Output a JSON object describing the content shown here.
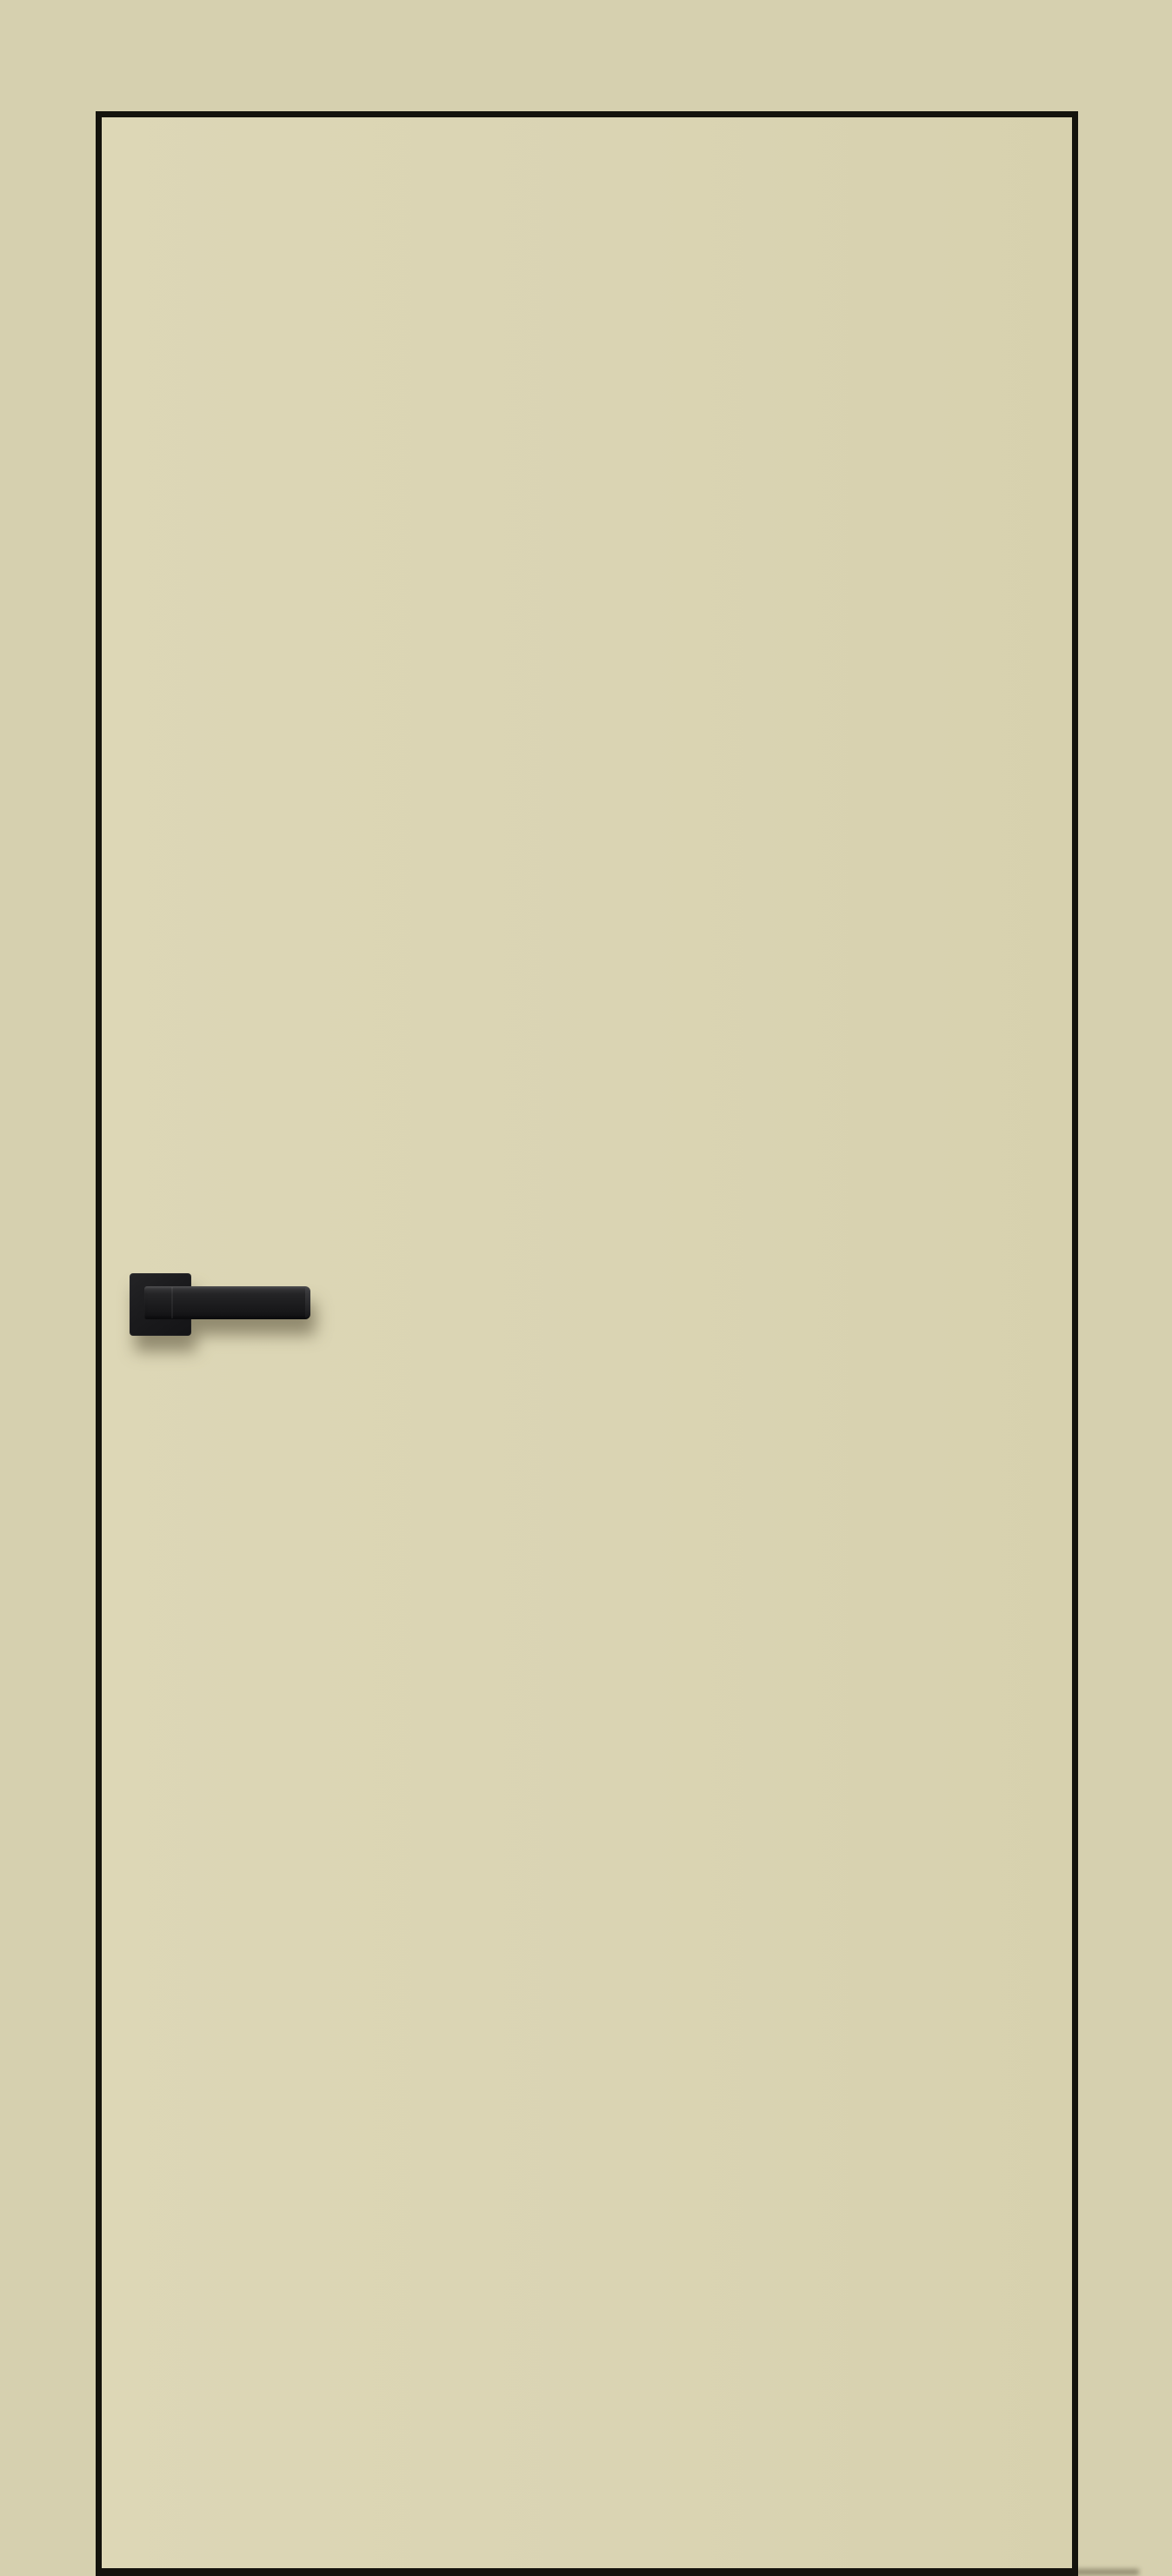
{
  "meta": {
    "type": "product-photo",
    "description": "Flush interior door in an ivory finish with thin black edge trim and a matte black square-rosette lever handle pointing right, photographed against a plain beige background. No visible text.",
    "visible_text": ""
  },
  "colors": {
    "background": "#d6d0af",
    "door_face": "#dad4b3",
    "door_face_light": "#ddd7b6",
    "door_face_dark": "#d7d1ae",
    "door_edge": "#14130d",
    "handle_base": "#1b1b1d",
    "handle_mid": "#242426",
    "handle_highlight": "#3c3c3e",
    "handle_shadow": "rgba(70,62,40,0.5)",
    "floor_shadow": "rgba(80,74,52,0.5)"
  },
  "door": {
    "style": "flush slab, no panels, no glazing",
    "edge_trim": "thin black edge band on top, left, right and bottom of the leaf",
    "handle_position": "left side of leaf, about mid-height",
    "handle_orientation": "horizontal lever pointing right",
    "rosette_shape": "square with slightly rounded corners"
  }
}
